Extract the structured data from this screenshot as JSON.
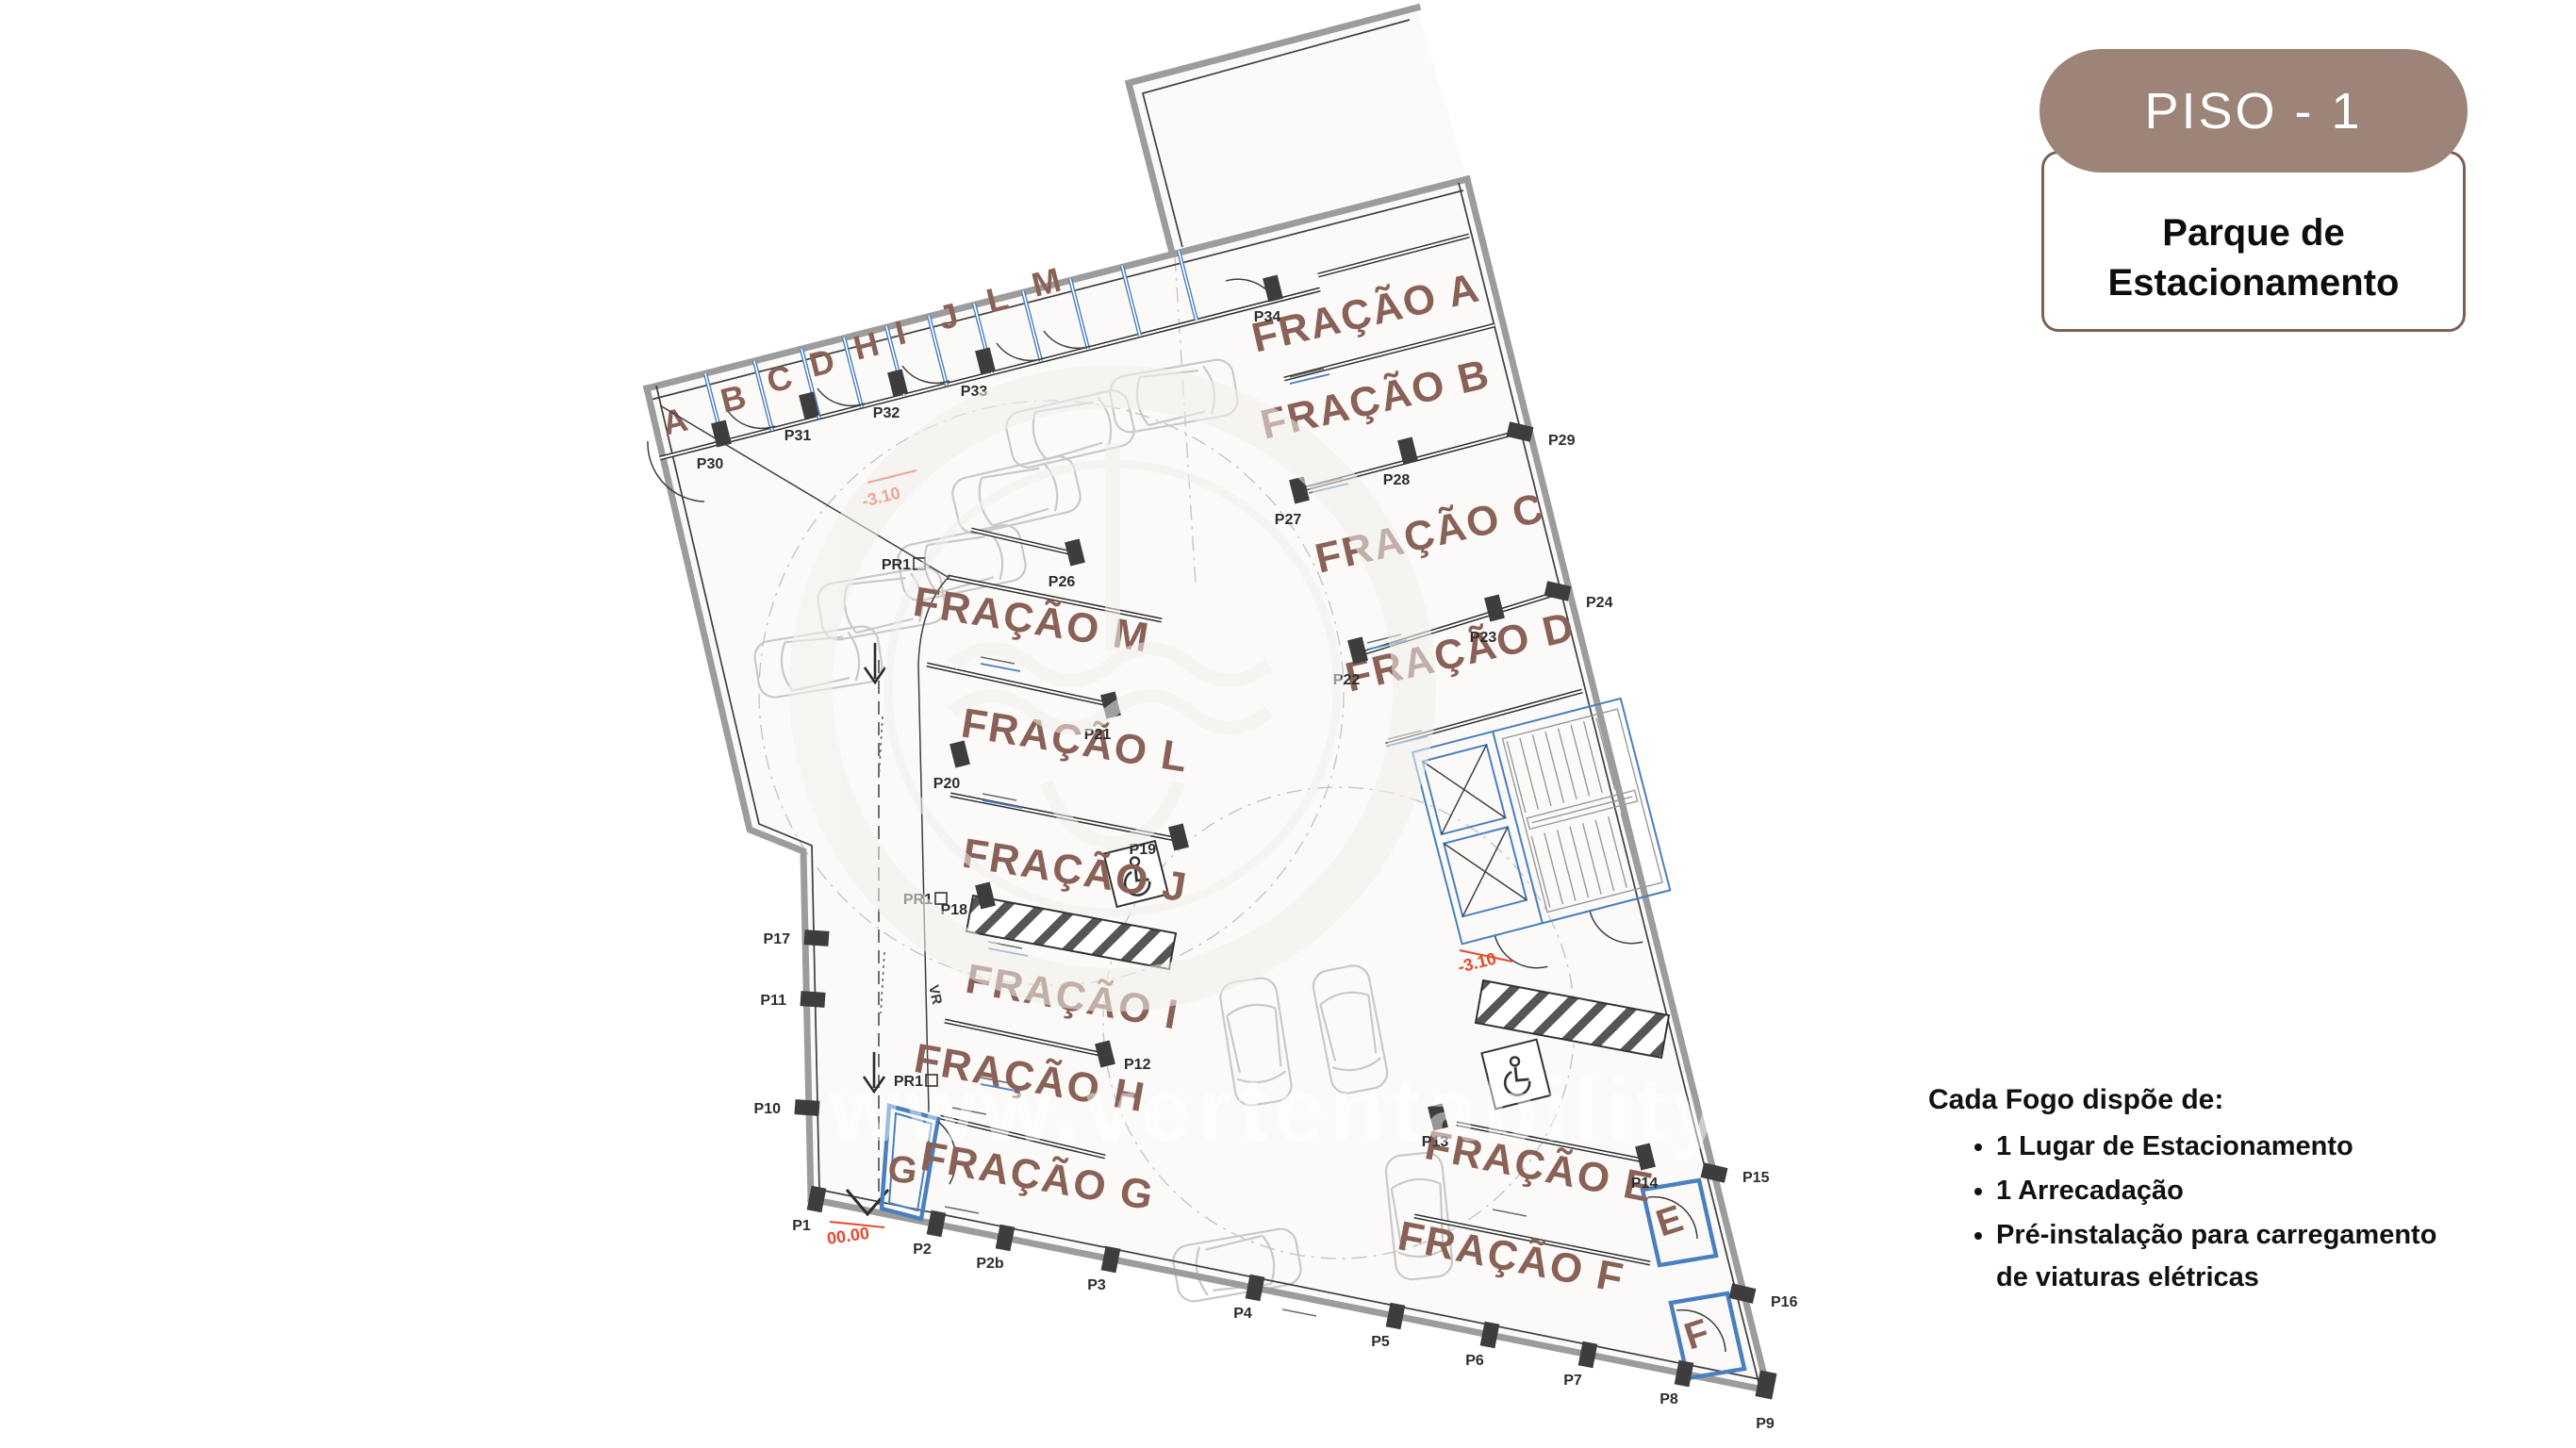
{
  "badge": {
    "title": "PISO - 1",
    "bg_color": "#9c8578"
  },
  "card": {
    "title": "Parque de Estacionamento",
    "border_color": "#7d6254"
  },
  "features": {
    "title": "Cada Fogo dispõe de:",
    "items": [
      "1 Lugar de Estacionamento",
      "1 Arrecadação",
      "Pré-instalação para carregamento de viaturas elétricas"
    ]
  },
  "watermark": {
    "text": "www.vertentability.pt"
  },
  "colors": {
    "fraction_text": "#8a6157",
    "plan_blue": "#4a7fbe",
    "annotation_red": "#e8492a",
    "wall_gray": "#9c9c9c"
  },
  "plan": {
    "fractions": {
      "a": "FRAÇÃO A",
      "b": "FRAÇÃO B",
      "c": "FRAÇÃO C",
      "d": "FRAÇÃO D",
      "e": "FRAÇÃO E",
      "f": "FRAÇÃO F",
      "g": "FRAÇÃO G",
      "h": "FRAÇÃO H",
      "i": "FRAÇÃO I",
      "j": "FRAÇÃO J",
      "l": "FRAÇÃO L",
      "m": "FRAÇÃO M"
    },
    "storage_letters": [
      "A",
      "B",
      "C",
      "D",
      "H",
      "I",
      "J",
      "L",
      "M"
    ],
    "unit_letters": {
      "e": "E",
      "f": "F",
      "g": "G"
    },
    "levels": {
      "basement": "-3.10",
      "entry": "00.00"
    },
    "lane": {
      "vr": "VR"
    },
    "columns": {
      "p1": "P1",
      "p2": "P2",
      "p2b": "P2b",
      "p3": "P3",
      "p4": "P4",
      "p5": "P5",
      "p6": "P6",
      "p7": "P7",
      "p8": "P8",
      "p9": "P9",
      "p10": "P10",
      "p11": "P11",
      "p12": "P12",
      "p13": "P13",
      "p14": "P14",
      "p15": "P15",
      "p16": "P16",
      "p17": "P17",
      "p18": "P18",
      "p19": "P19",
      "p20": "P20",
      "p21": "P21",
      "p22": "P22",
      "p23": "P23",
      "p24": "P24",
      "p26": "P26",
      "p27": "P27",
      "p28": "P28",
      "p29": "P29",
      "p30": "P30",
      "p31": "P31",
      "p32": "P32",
      "p33": "P33",
      "p34": "P34",
      "pr1": "PR1"
    }
  }
}
